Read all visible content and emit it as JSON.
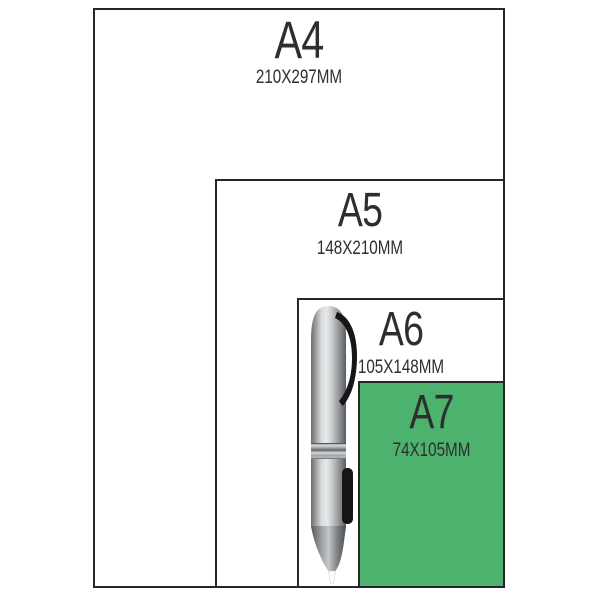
{
  "sheets": [
    {
      "id": "a4",
      "label": "A4",
      "dimensions": "210X297MM"
    },
    {
      "id": "a5",
      "label": "A5",
      "dimensions": "148X210MM"
    },
    {
      "id": "a6",
      "label": "A6",
      "dimensions": "105X148MM"
    },
    {
      "id": "a7",
      "label": "A7",
      "dimensions": "74X105MM"
    }
  ],
  "colors": {
    "a7_fill": "#4cb26e",
    "border": "#262626",
    "text": "#2e2e2e",
    "background": "#ffffff"
  },
  "objects": {
    "pen": "silver-ballpoint-pen"
  }
}
